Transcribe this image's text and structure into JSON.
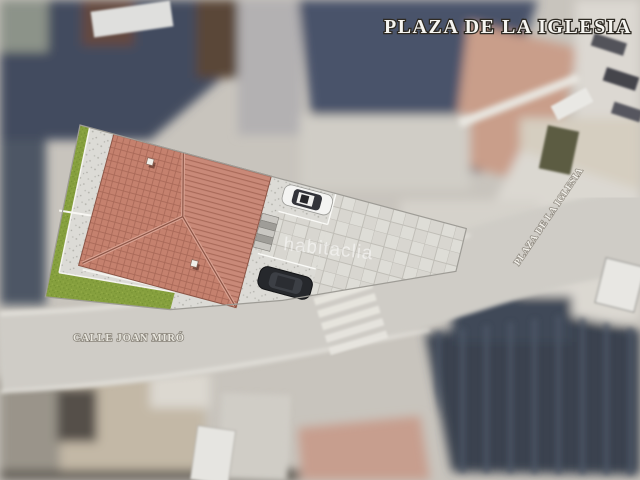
{
  "labels": {
    "title": "PLAZA DE LA IGLESIA",
    "street_main": "CALLE JOAN MIRÓ",
    "street_side": "PLAZA DE LA IGLESIA",
    "watermark": "habitaclia"
  },
  "colors": {
    "roof_tile": "#c5816e",
    "roof_ridge": "#8d5546",
    "grass": "#86a03e",
    "pavement_speckled": "#dcdbd6",
    "pavement_tiled": "#deddd7",
    "plan_outline": "#9e9c96",
    "car_white": "#f4f4f2",
    "car_black": "#26282c",
    "satellite_dark_roof": "#434c5e",
    "satellite_pink_building": "#c99e8a",
    "street_surface": "#cfccc6"
  }
}
